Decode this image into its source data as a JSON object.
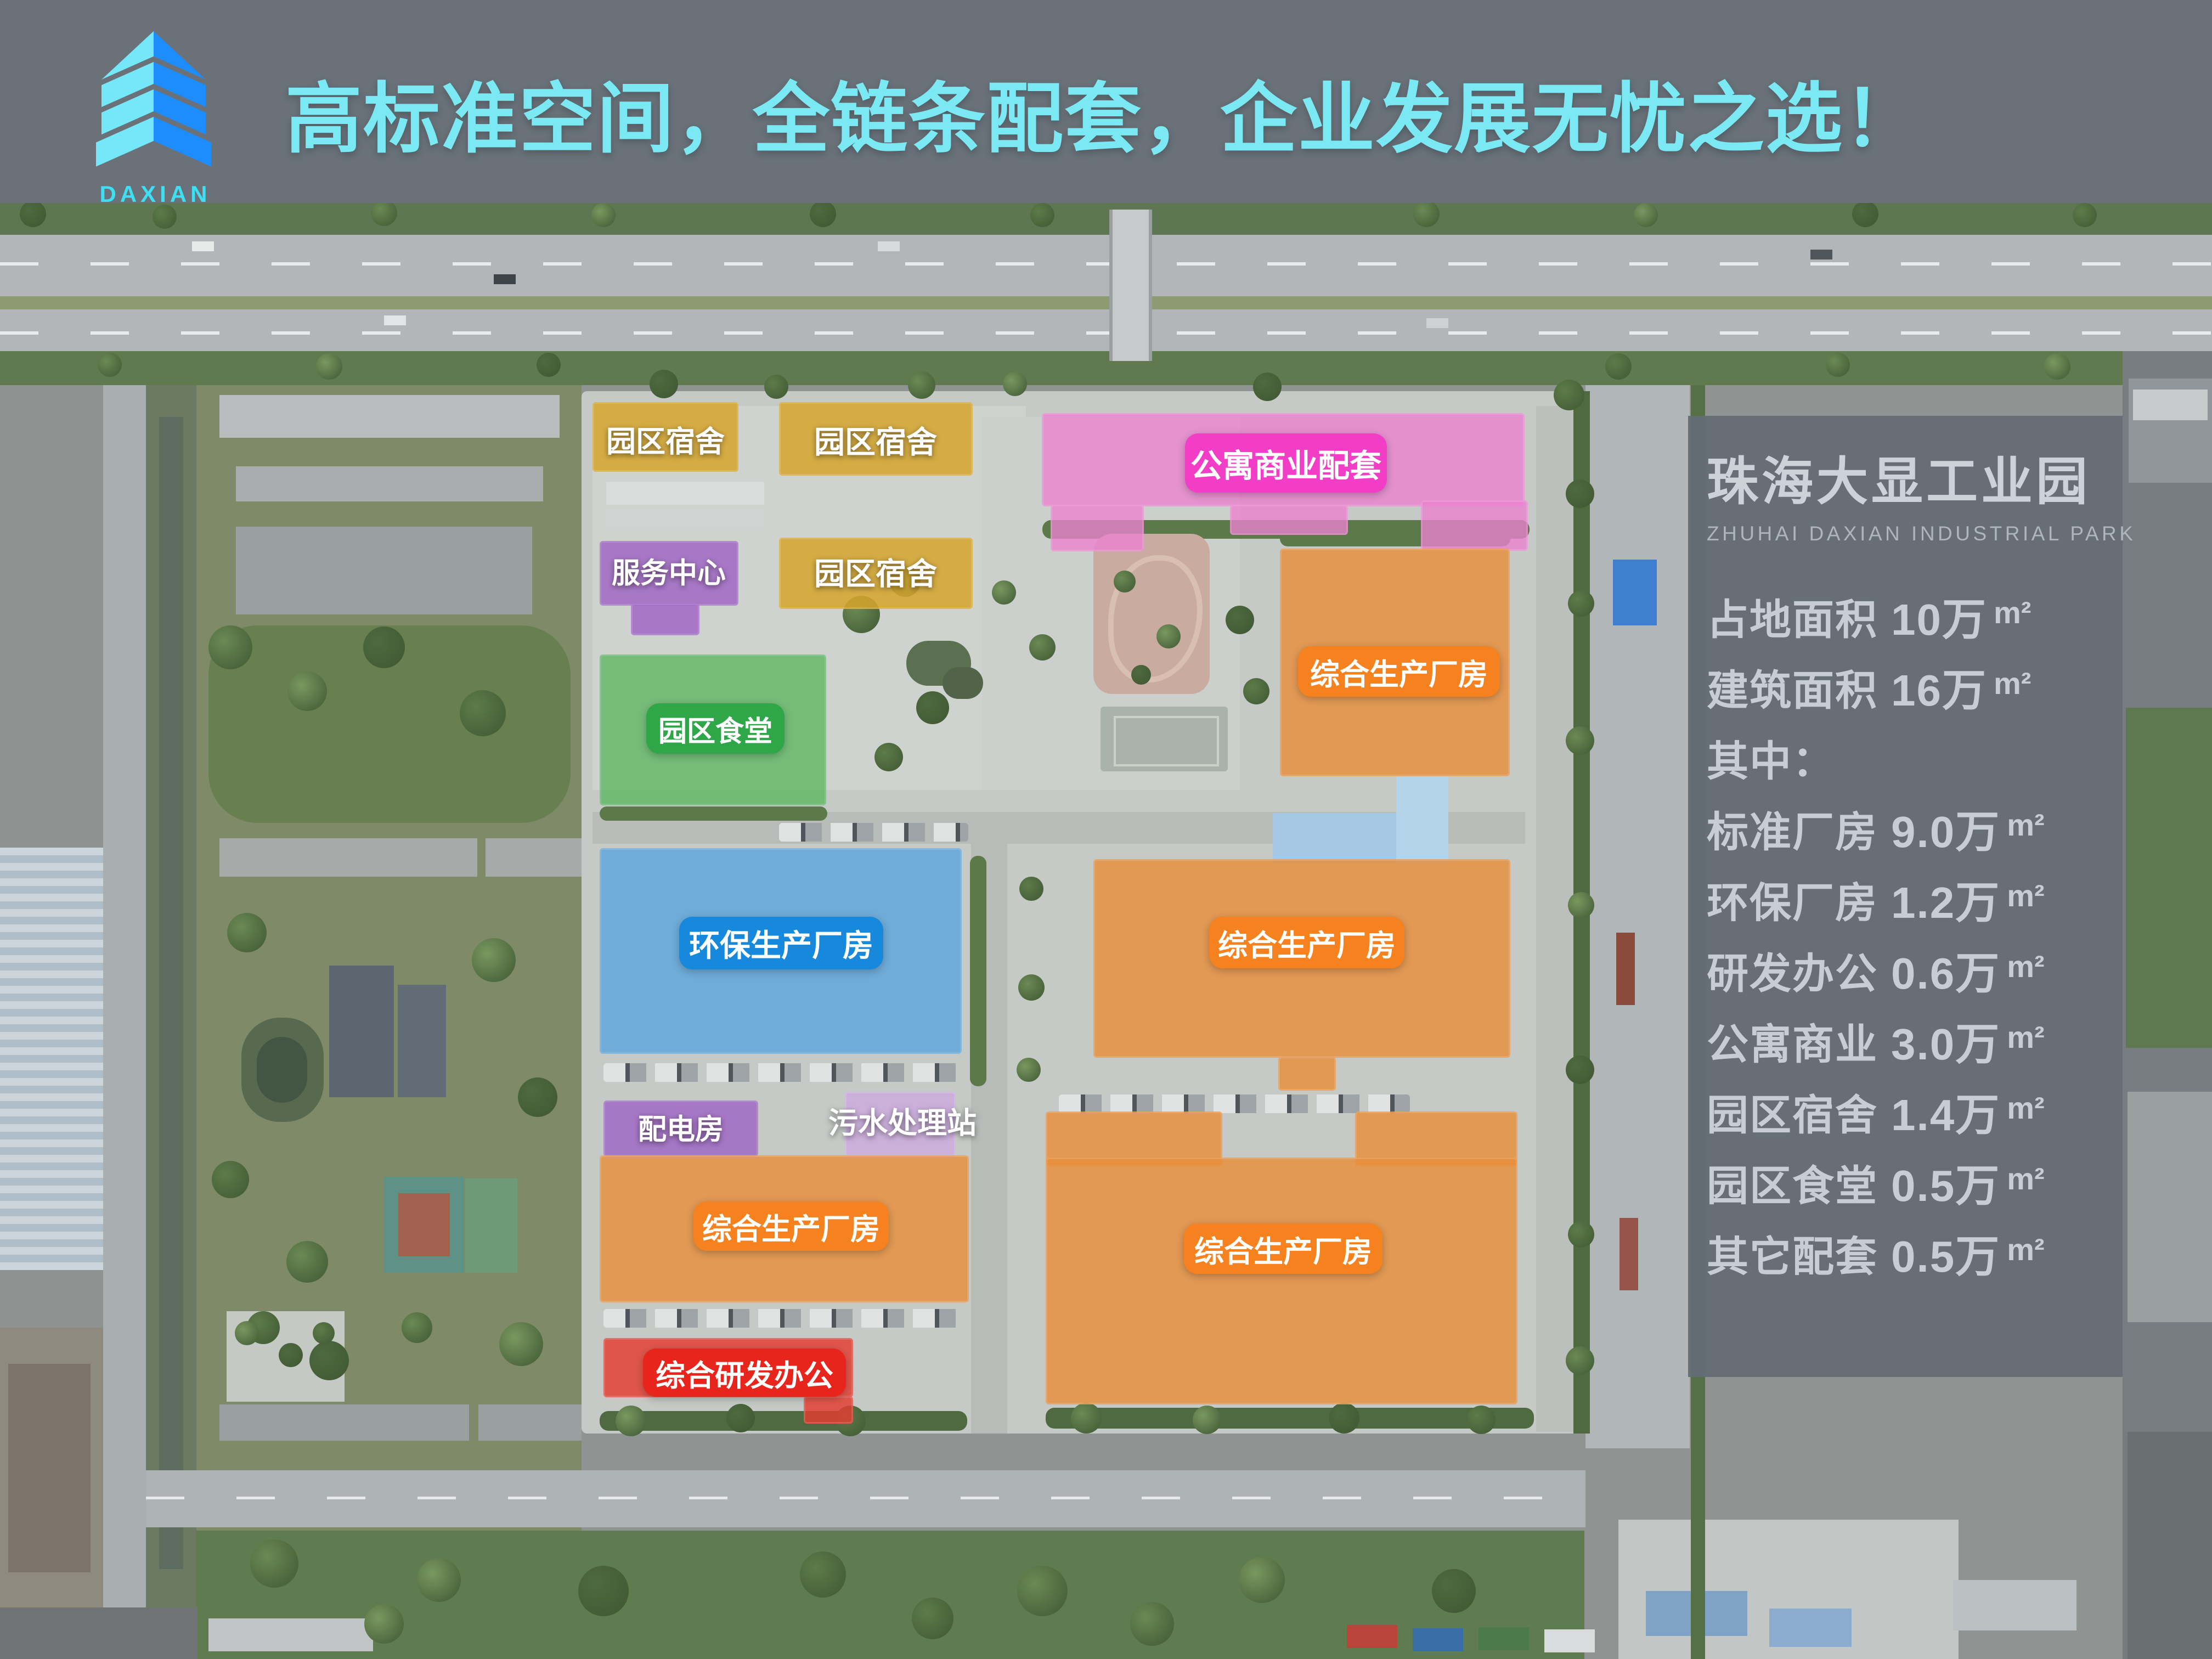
{
  "header": {
    "logo_text": "DAXIAN",
    "title": "高标准空间，全链条配套，企业发展无忧之选！",
    "title_color": "#7BE9F3"
  },
  "map": {
    "buildings": [
      {
        "id": "dorm-nw",
        "label": "园区宿舍",
        "label_style": "plain",
        "overlay": "rgba(214,164,44,0.85)",
        "badge": null
      },
      {
        "id": "dorm-n",
        "label": "园区宿舍",
        "label_style": "plain",
        "overlay": "rgba(214,164,44,0.85)",
        "badge": null
      },
      {
        "id": "apartment",
        "label": "公寓商业配套",
        "label_style": "badge",
        "overlay": "rgba(236,128,208,0.78)",
        "badge": "#F23EC7"
      },
      {
        "id": "service",
        "label": "服务中心",
        "label_style": "plain",
        "overlay": "rgba(158,98,196,0.80)",
        "badge": null
      },
      {
        "id": "dorm-mid",
        "label": "园区宿舍",
        "label_style": "plain",
        "overlay": "rgba(214,164,44,0.85)",
        "badge": null
      },
      {
        "id": "canteen",
        "label": "园区食堂",
        "label_style": "badge",
        "overlay": "rgba(92,182,98,0.80)",
        "badge": "#2FA648"
      },
      {
        "id": "plant-ne",
        "label": "综合生产厂房",
        "label_style": "badge",
        "overlay": "rgba(232,142,58,0.82)",
        "badge": "#F5821E"
      },
      {
        "id": "eco-plant",
        "label": "环保生产厂房",
        "label_style": "badge",
        "overlay": "rgba(86,164,220,0.78)",
        "badge": "#1789DC"
      },
      {
        "id": "plant-center",
        "label": "综合生产厂房",
        "label_style": "badge",
        "overlay": "rgba(232,142,58,0.82)",
        "badge": "#F5821E"
      },
      {
        "id": "power",
        "label": "配电房",
        "label_style": "plain",
        "overlay": "rgba(158,98,196,0.80)",
        "badge": null
      },
      {
        "id": "sewage",
        "label": "污水处理站",
        "label_style": "plain",
        "overlay": "rgba(206,162,230,0.65)",
        "badge": null
      },
      {
        "id": "plant-sw",
        "label": "综合生产厂房",
        "label_style": "badge",
        "overlay": "rgba(232,142,58,0.82)",
        "badge": "#F5821E"
      },
      {
        "id": "rd-office",
        "label": "综合研发办公",
        "label_style": "badge",
        "overlay": "rgba(228,58,48,0.82)",
        "badge": "#E8251D"
      },
      {
        "id": "plant-se",
        "label": "综合生产厂房",
        "label_style": "badge",
        "overlay": "rgba(232,142,58,0.82)",
        "badge": "#F5821E"
      }
    ]
  },
  "info_panel": {
    "title": "珠海大显工业园",
    "subtitle": "ZHUHAI DAXIAN INDUSTRIAL PARK",
    "rows": [
      {
        "label": "占地面积",
        "value": "10万",
        "unit": "m²"
      },
      {
        "label": "建筑面积",
        "value": "16万",
        "unit": "m²"
      },
      {
        "label": "其中：",
        "value": "",
        "unit": ""
      },
      {
        "label": "标准厂房",
        "value": "9.0万",
        "unit": "m²"
      },
      {
        "label": "环保厂房",
        "value": "1.2万",
        "unit": "m²"
      },
      {
        "label": "研发办公",
        "value": "0.6万",
        "unit": "m²"
      },
      {
        "label": "公寓商业",
        "value": "3.0万",
        "unit": "m²"
      },
      {
        "label": "园区宿舍",
        "value": "1.4万",
        "unit": "m²"
      },
      {
        "label": "园区食堂",
        "value": "0.5万",
        "unit": "m²"
      },
      {
        "label": "其它配套",
        "value": "0.5万",
        "unit": "m²"
      }
    ]
  },
  "colors": {
    "header_bg": "#6A7179",
    "accent_cyan": "#7BE9F3",
    "logo_cyan": "#3EDFF2",
    "panel_bg": "#656C75",
    "badge_pink": "#F23EC7",
    "badge_green": "#2FA648",
    "badge_blue": "#1789DC",
    "badge_orange": "#F5821E",
    "badge_red": "#E8251D"
  }
}
